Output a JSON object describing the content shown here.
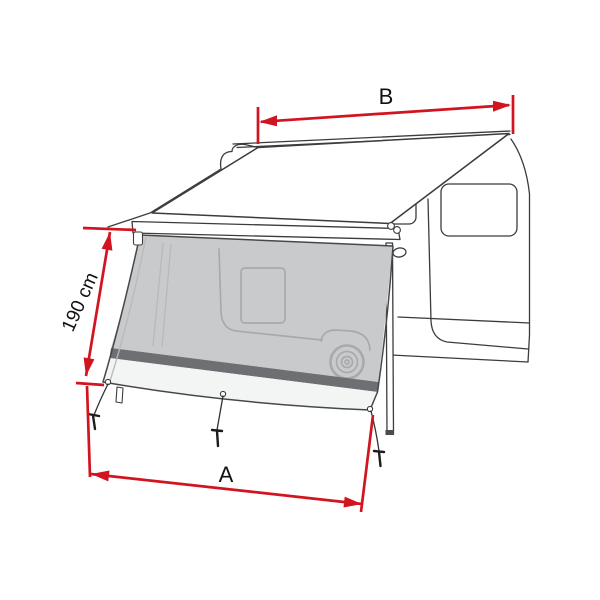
{
  "figure": {
    "labels": {
      "dimension_b": "B",
      "dimension_a": "A",
      "dimension_height": "190 cm"
    },
    "colors": {
      "dimension_red": "#d21420",
      "mesh_gray": "#c9cacc",
      "band_dark_gray": "#6d7073",
      "skirt_light": "#f3f4f4",
      "outline_dark": "#3a3c3e",
      "silhouette_gray": "#a7aaad",
      "background": "#ffffff"
    }
  }
}
